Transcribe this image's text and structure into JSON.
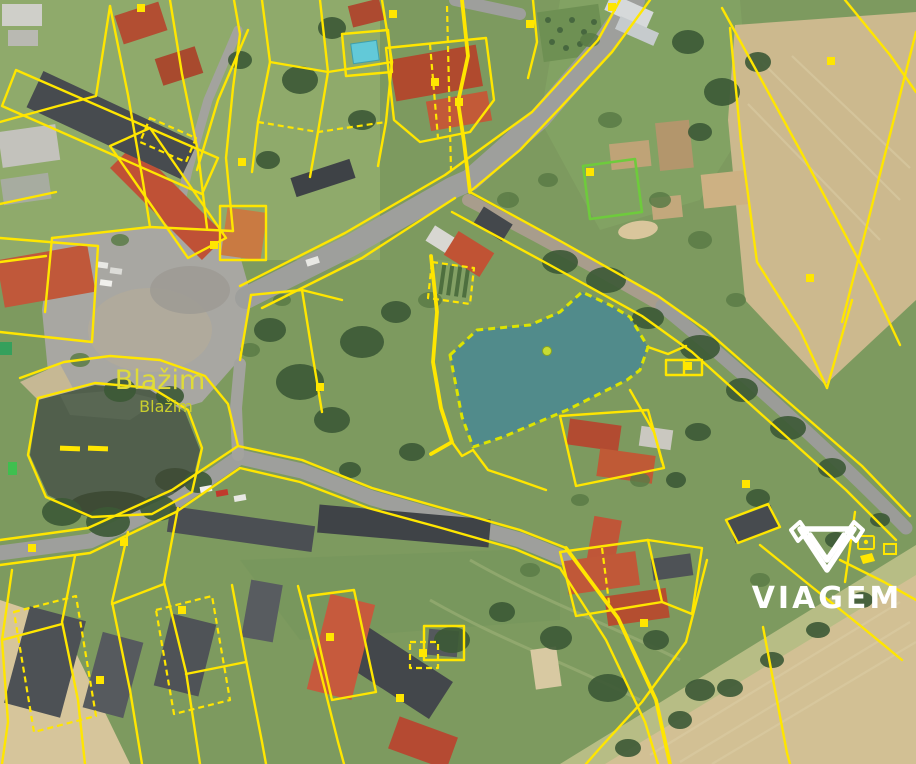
{
  "map": {
    "place_labels": {
      "large": "Blažim",
      "small": "Blažim"
    },
    "watermark": {
      "text": "VIAGEM",
      "color": "#ffffff"
    },
    "colors": {
      "cadastral_line": "#ffe600",
      "highlight_fill": "#2e7fae",
      "highlight_border": "#dde400",
      "label": "#dfdb39",
      "road": "#9e9f9c",
      "water": "#515f4c",
      "field": "#ccb98e",
      "grass": "#7d9a5f"
    },
    "highlighted_parcel": {
      "points": "450,355 477,330 530,325 560,312 582,292 610,305 630,317 648,347 640,370 627,380 567,410 503,437 473,447 462,417",
      "fill_opacity": "0.55"
    },
    "markers": [
      {
        "x": 137,
        "y": 4
      },
      {
        "x": 238,
        "y": 158
      },
      {
        "x": 210,
        "y": 241
      },
      {
        "x": 316,
        "y": 383
      },
      {
        "x": 389,
        "y": 10
      },
      {
        "x": 431,
        "y": 78
      },
      {
        "x": 455,
        "y": 98
      },
      {
        "x": 526,
        "y": 20
      },
      {
        "x": 586,
        "y": 168
      },
      {
        "x": 827,
        "y": 57
      },
      {
        "x": 806,
        "y": 274
      },
      {
        "x": 742,
        "y": 480
      },
      {
        "x": 640,
        "y": 619
      },
      {
        "x": 396,
        "y": 694
      },
      {
        "x": 326,
        "y": 633
      },
      {
        "x": 178,
        "y": 606
      },
      {
        "x": 28,
        "y": 544
      },
      {
        "x": 96,
        "y": 676
      },
      {
        "x": 419,
        "y": 649
      },
      {
        "x": 120,
        "y": 538
      },
      {
        "x": 684,
        "y": 362
      },
      {
        "x": 608,
        "y": 3
      }
    ]
  }
}
